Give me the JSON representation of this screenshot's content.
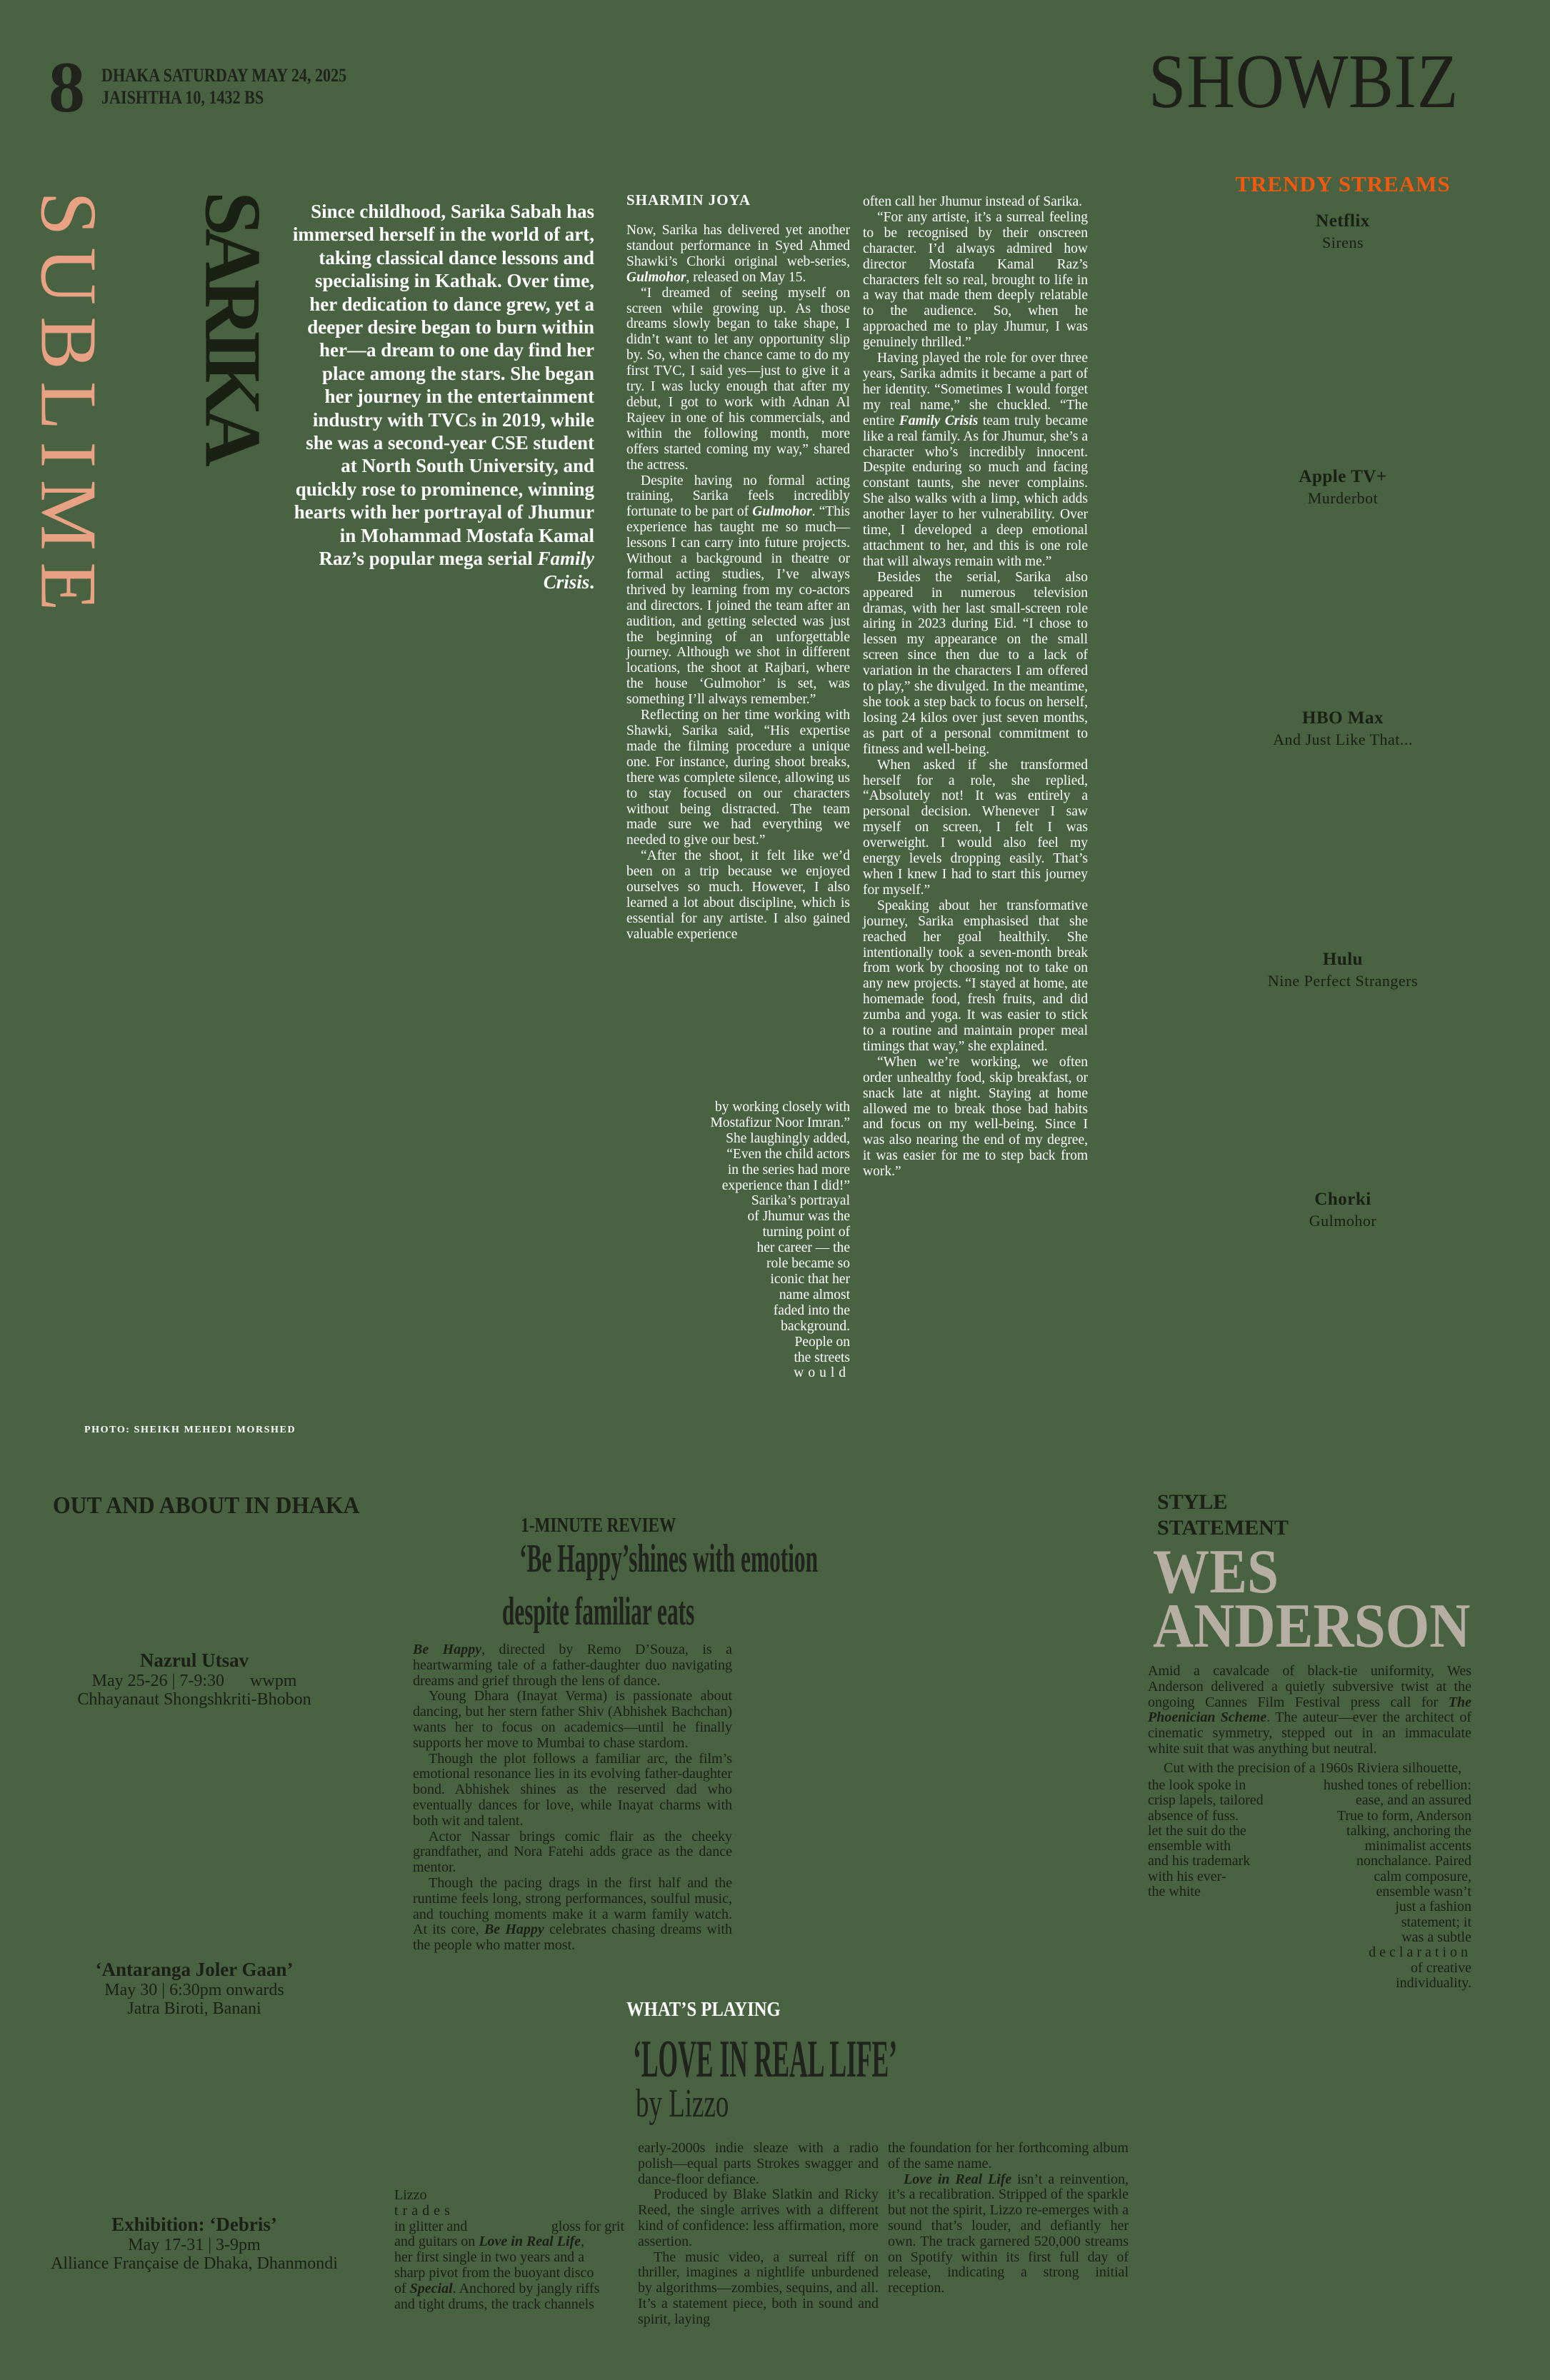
{
  "colors": {
    "background": "#486242",
    "ink": "#1C2016",
    "paper_text": "#FFFFFF",
    "accent_orange": "#F2590F",
    "accent_peach": "#E9A183",
    "headline_greige": "#B7AEA3"
  },
  "header": {
    "page_number": "8",
    "date_line1": "DHAKA SATURDAY MAY 24, 2025",
    "date_line2": "JAISHTHA 10, 1432 BS",
    "section": "SHOWBIZ"
  },
  "trendy_streams": {
    "title": "TRENDY STREAMS",
    "items": [
      {
        "platform": "Netflix",
        "show": "Sirens"
      },
      {
        "platform": "Apple TV+",
        "show": "Murderbot"
      },
      {
        "platform": "HBO Max",
        "show": "And Just Like That..."
      },
      {
        "platform": "Hulu",
        "show": "Nine Perfect Strangers"
      },
      {
        "platform": "Chorki",
        "show": "Gulmohor"
      }
    ]
  },
  "feature": {
    "vertical_word_1": "SUBLIME",
    "vertical_word_2": "SARIKA",
    "byline": "SHARMIN JOYA",
    "intro": "Since childhood, Sarika Sabah has immersed herself in the world of art, taking classical dance lessons and specialising in Kathak. Over time, her dedication to dance grew, yet a deeper desire began to burn within her—a dream to one day find her place among the stars. She began her journey in the entertainment industry with TVCs in 2019, while she was a second-year CSE student at North South University, and quickly rose to prominence, winning hearts with her portrayal of Jhumur in Mohammad Mostafa Kamal Raz’s popular mega serial *Family Crisis*.",
    "col1_paragraphs": [
      "Now, Sarika has delivered yet another standout performance in Syed Ahmed Shawki’s Chorki original web-series, *Gulmohor*, released on May 15.",
      "“I dreamed of seeing myself on screen while growing up. As those dreams slowly began to take shape, I didn’t want to let any opportunity slip by. So, when the chance came to do my first TVC, I said yes—just to give it a try. I was lucky enough that after my debut, I got to work with Adnan Al Rajeev in one of his commercials, and within the following month, more offers started coming my way,” shared the actress.",
      "Despite having no formal acting training, Sarika feels incredibly fortunate to be part of *Gulmohor*. “This experience has taught me so much—lessons I can carry into future projects. Without a background in theatre or formal acting studies, I’ve always thrived by learning from my co-actors and directors. I joined the team after an audition, and getting selected was just the beginning of an unforgettable journey. Although we shot in different locations, the shoot at Rajbari, where the house ‘Gulmohor’ is set, was something I’ll always remember.”",
      "Reflecting on her time working with Shawki, Sarika said, “His expertise made the filming procedure a unique one. For instance, during shoot breaks, there was complete silence, allowing us to stay focused on our characters without being distracted. The team made sure we had everything we needed to give our best.”",
      "“After the shoot, it felt like we’d been on a trip because we enjoyed ourselves so much. However, I also learned a lot about discipline, which is essential for any artiste. I also gained valuable experience"
    ],
    "col1_taper_lines": [
      "by working closely with",
      "Mostafizur Noor Imran.”",
      "She laughingly added,",
      "“Even the child actors",
      "in the series had more",
      "experience than I did!”",
      "Sarika’s portrayal",
      "of Jhumur was the",
      "turning point of",
      "her career — the",
      "role became so",
      "iconic that her",
      "name almost",
      "faded into the",
      "background.",
      "People on",
      "the streets",
      {
        "t": "would",
        "ls": true
      }
    ],
    "col2_paragraphs": [
      "often call her Jhumur instead of Sarika.",
      "“For any artiste, it’s a surreal feeling to be recognised by their onscreen character.  I’d always admired how director Mostafa Kamal Raz’s characters felt so real, brought to life in a way that made them deeply relatable to the audience. So, when he approached me to play Jhumur, I was genuinely thrilled.”",
      "Having played the role for over three years, Sarika admits it became a part of her identity. “Sometimes I would forget my real name,” she chuckled. “The entire *Family Crisis* team truly became like a real family. As for Jhumur, she’s a character who’s incredibly innocent. Despite enduring so much and facing constant taunts, she never complains. She also walks with a limp, which adds another layer to her vulnerability. Over time, I developed a deep emotional attachment to her, and this is one role that will always remain with me.”",
      "Besides the serial, Sarika also appeared in numerous television dramas, with her last small-screen role airing in 2023 during Eid. “I chose to lessen my appearance on the small screen since then due to a lack of variation in the characters I am offered to play,” she divulged. In the meantime, she took a step back to focus on herself, losing 24 kilos over just seven months, as part of a personal commitment to fitness and well-being.",
      "When asked if she transformed herself for a role, she replied, “Absolutely not! It was entirely a personal decision. Whenever I saw myself on screen, I felt I was overweight. I would also feel my energy levels dropping easily. That’s when I knew I had to start this journey for myself.”",
      "Speaking about her transformative journey, Sarika emphasised that she reached her goal healthily. She intentionally took a seven-month break from work by choosing not to take on any new projects. “I stayed at home, ate homemade food, fresh fruits, and did zumba and yoga. It was easier to stick to a routine and maintain proper meal timings that way,” she explained.",
      "“When we’re working, we often order unhealthy food, skip breakfast, or snack late at night. Staying at home allowed me to break those bad habits and focus on my well-being. Since I was also nearing the end of my degree, it was easier for me to step back from work.”"
    ],
    "photo_credit": "PHOTO: SHEIKH MEHEDI MORSHED"
  },
  "out_and_about": {
    "title": "OUT AND ABOUT IN DHAKA",
    "events": [
      {
        "name": "Nazrul Utsav",
        "when": "May 25-26 | 7-9:30      wwpm",
        "where": "Chhayanaut Shongshkriti-Bhobon"
      },
      {
        "name": "‘Antaranga Joler Gaan’",
        "when": "May 30 | 6:30pm onwards",
        "where": "Jatra Biroti, Banani"
      },
      {
        "name": "Exhibition: ‘Debris’",
        "when": "May 17-31 | 3-9pm",
        "where": "Alliance Française de Dhaka, Dhanmondi"
      }
    ]
  },
  "review": {
    "kicker": "1-MINUTE REVIEW",
    "headline_line1": "‘Be Happy’shines with emotion",
    "headline_line2": "despite familiar eats",
    "paragraphs": [
      "*Be Happy*, directed by Remo D’Souza, is a heartwarming tale of a father-daughter duo navigating dreams and grief through the lens of dance.",
      "Young Dhara (Inayat Verma) is passionate about dancing, but her stern father Shiv (Abhishek Bachchan) wants her to focus on academics—until he finally supports her move to Mumbai to chase stardom.",
      "Though the plot follows a familiar arc, the film’s emotional resonance lies in its evolving father-daughter bond. Abhishek shines as the reserved dad who eventually dances for love, while Inayat charms with both wit and talent.",
      "Actor Nassar brings comic flair as the cheeky grandfather, and Nora Fatehi adds grace as the dance mentor.",
      "Though the pacing drags in the first half and the runtime feels long, strong performances, soulful music, and touching moments make it a warm family watch. At its core, *Be Happy* celebrates chasing dreams with the people who matter most."
    ]
  },
  "whats_playing": {
    "kicker": "WHAT’S PLAYING",
    "title": "‘LOVE IN REAL LIFE’",
    "subtitle": "by Lizzo",
    "intro_lines": [
      "Lizzo",
      {
        "t": "trades",
        "ls": true
      },
      {
        "l": "in glitter and",
        "r": "gloss for grit"
      },
      "and guitars on *Love in Real Life*,",
      "her first single in two years and a",
      "sharp pivot from the buoyant disco",
      "of *Special*. Anchored by jangly riffs",
      "and tight drums, the track channels"
    ],
    "col1_paragraphs": [
      "early-2000s indie sleaze with a radio polish—equal parts Strokes swagger and dance-floor defiance.",
      "Produced by Blake Slatkin and Ricky Reed, the single arrives with a different kind of confidence: less affirmation, more assertion.",
      "The music video, a surreal riff on thriller, imagines a nightlife unburdened by algorithms—zombies, sequins, and all. It’s a statement piece, both in sound and spirit, laying"
    ],
    "col2_paragraphs": [
      "the foundation for her forthcoming album of the same name.",
      "*Love in Real Life* isn’t a reinvention, it’s a recalibration. Stripped of the sparkle but not the spirit, Lizzo re-emerges with a sound that’s louder, and defiantly her own. The track garnered 520,000 streams on Spotify within its first full day of release, indicating a strong initial reception."
    ]
  },
  "style_statement": {
    "kicker_line1": "STYLE",
    "kicker_line2": "STATEMENT",
    "name_line1": "WES",
    "name_line2": "ANDERSON",
    "paragraphs": [
      "Amid a cavalcade of black-tie uniformity, Wes Anderson delivered a quietly subversive twist at the ongoing Cannes Film Festival press call for *The Phoenician Scheme*. The auteur—ever the architect of cinematic symmetry, stepped out in an immaculate white suit that was anything but neutral."
    ],
    "wrap_full_line": "Cut with the precision of a 1960s Riviera silhouette,",
    "wrap_left_lines": [
      "the look spoke in",
      "crisp lapels, tailored",
      "absence of fuss.",
      "let the suit do the",
      "ensemble with",
      "and his trademark",
      "with his ever-",
      "the white"
    ],
    "wrap_right_lines": [
      "hushed tones of rebellion:",
      "ease, and an assured",
      "True to form, Anderson",
      "talking, anchoring the",
      "minimalist accents",
      "nonchalance. Paired",
      "calm composure,",
      "ensemble wasn’t",
      "just a fashion",
      "statement; it",
      "was a subtle",
      {
        "t": "declaration",
        "ls": true
      },
      "of creative",
      "individuality."
    ]
  }
}
